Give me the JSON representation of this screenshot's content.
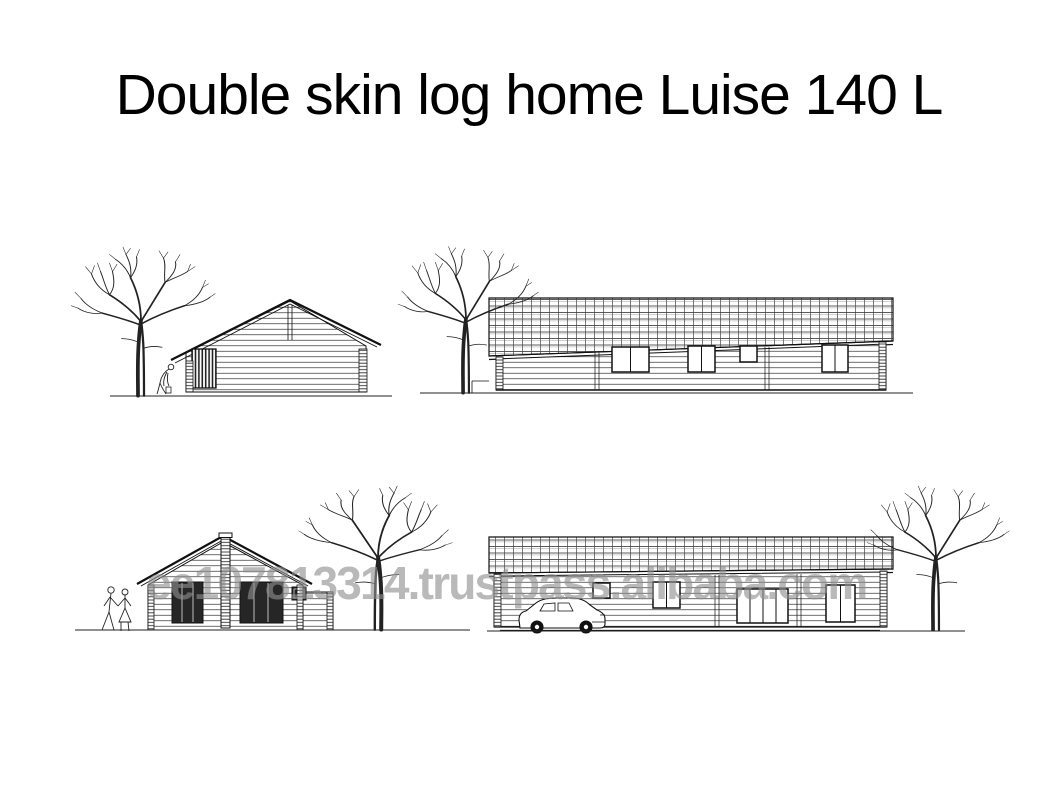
{
  "page": {
    "title": "Double skin log home Luise 140 L",
    "background_color": "#ffffff",
    "ink_color": "#1a1a1a"
  },
  "watermark": {
    "text": "ee107813314.trustpass.alibaba.com",
    "color": "#8f8f8f"
  },
  "drawing": {
    "views": [
      {
        "name": "gable-end-elevation-top-left",
        "elements": [
          "bare-tree",
          "bending-person",
          "log-gable-house",
          "slatted-door",
          "ground-line"
        ]
      },
      {
        "name": "side-elevation-top-right",
        "elements": [
          "bare-tree",
          "tiled-roof",
          "log-wall",
          "windows",
          "ground-line"
        ]
      },
      {
        "name": "gable-end-elevation-bottom-left",
        "elements": [
          "walking-couple",
          "log-gable-house",
          "chimney",
          "dark-doors",
          "bare-tree",
          "ground-line"
        ]
      },
      {
        "name": "side-elevation-bottom-right",
        "elements": [
          "tiled-roof",
          "log-wall",
          "windows",
          "patio-door",
          "car",
          "bare-tree",
          "ground-line"
        ]
      }
    ]
  }
}
